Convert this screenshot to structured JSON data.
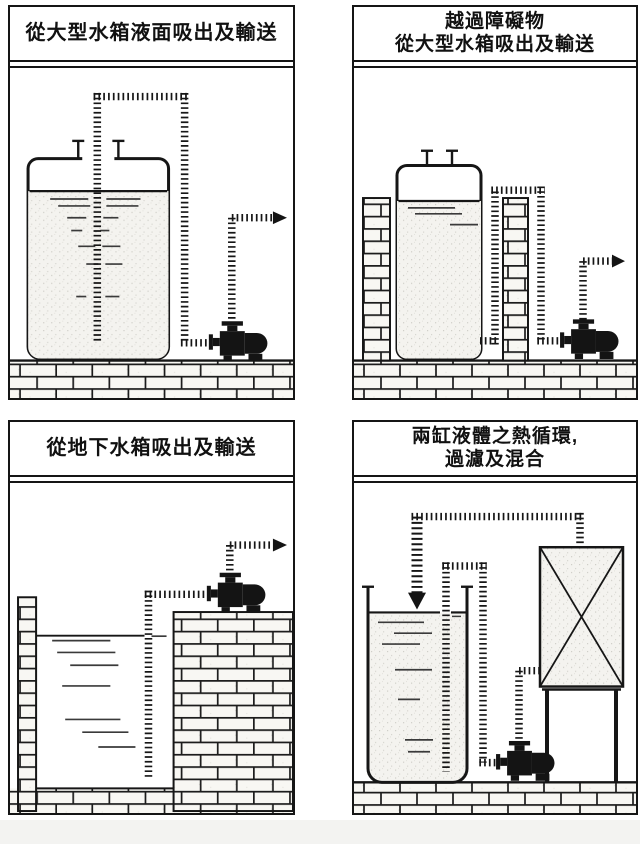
{
  "sheet": {
    "background": "#ffffff",
    "ink_color": "#151515",
    "brick_fill": "#f8f7f3",
    "liquid_fill": "#f4f3ef"
  },
  "panels": [
    {
      "id": "suction-from-tank-surface",
      "title_lines": [
        "從大型水箱液面吸出及輸送"
      ],
      "components": [
        "large-storage-tank",
        "tank-vent-nozzles",
        "liquid",
        "suction-pipe-dashed",
        "pump",
        "discharge-pipe-dashed",
        "flow-arrow-right",
        "brick-floor"
      ]
    },
    {
      "id": "over-obstacle-from-tank",
      "title_lines": [
        "越過障礙物",
        "從大型水箱吸出及輸送"
      ],
      "components": [
        "brick-wall-left",
        "large-storage-tank",
        "tank-vent-nozzles",
        "liquid",
        "suction-pipe-over-wall",
        "brick-wall-obstacle",
        "pump",
        "discharge-pipe-dashed",
        "flow-arrow-right",
        "brick-floor"
      ]
    },
    {
      "id": "suction-from-underground-tank",
      "title_lines": [
        "從地下水箱吸出及輸送"
      ],
      "components": [
        "brick-wall-left",
        "underground-pit",
        "water",
        "suction-pipe-dashed",
        "brick-platform",
        "pump",
        "discharge-pipe-dashed",
        "flow-arrow-right",
        "brick-floor"
      ]
    },
    {
      "id": "two-tank-circulation",
      "title_lines": [
        "兩缸液體之熱循環,",
        "過濾及混合"
      ],
      "components": [
        "open-tank",
        "liquid",
        "return-arrow-down",
        "transfer-pipe-over-rim",
        "pump",
        "filter-heat-exchanger-box",
        "stand-legs",
        "top-circulation-pipe",
        "brick-floor"
      ]
    }
  ]
}
